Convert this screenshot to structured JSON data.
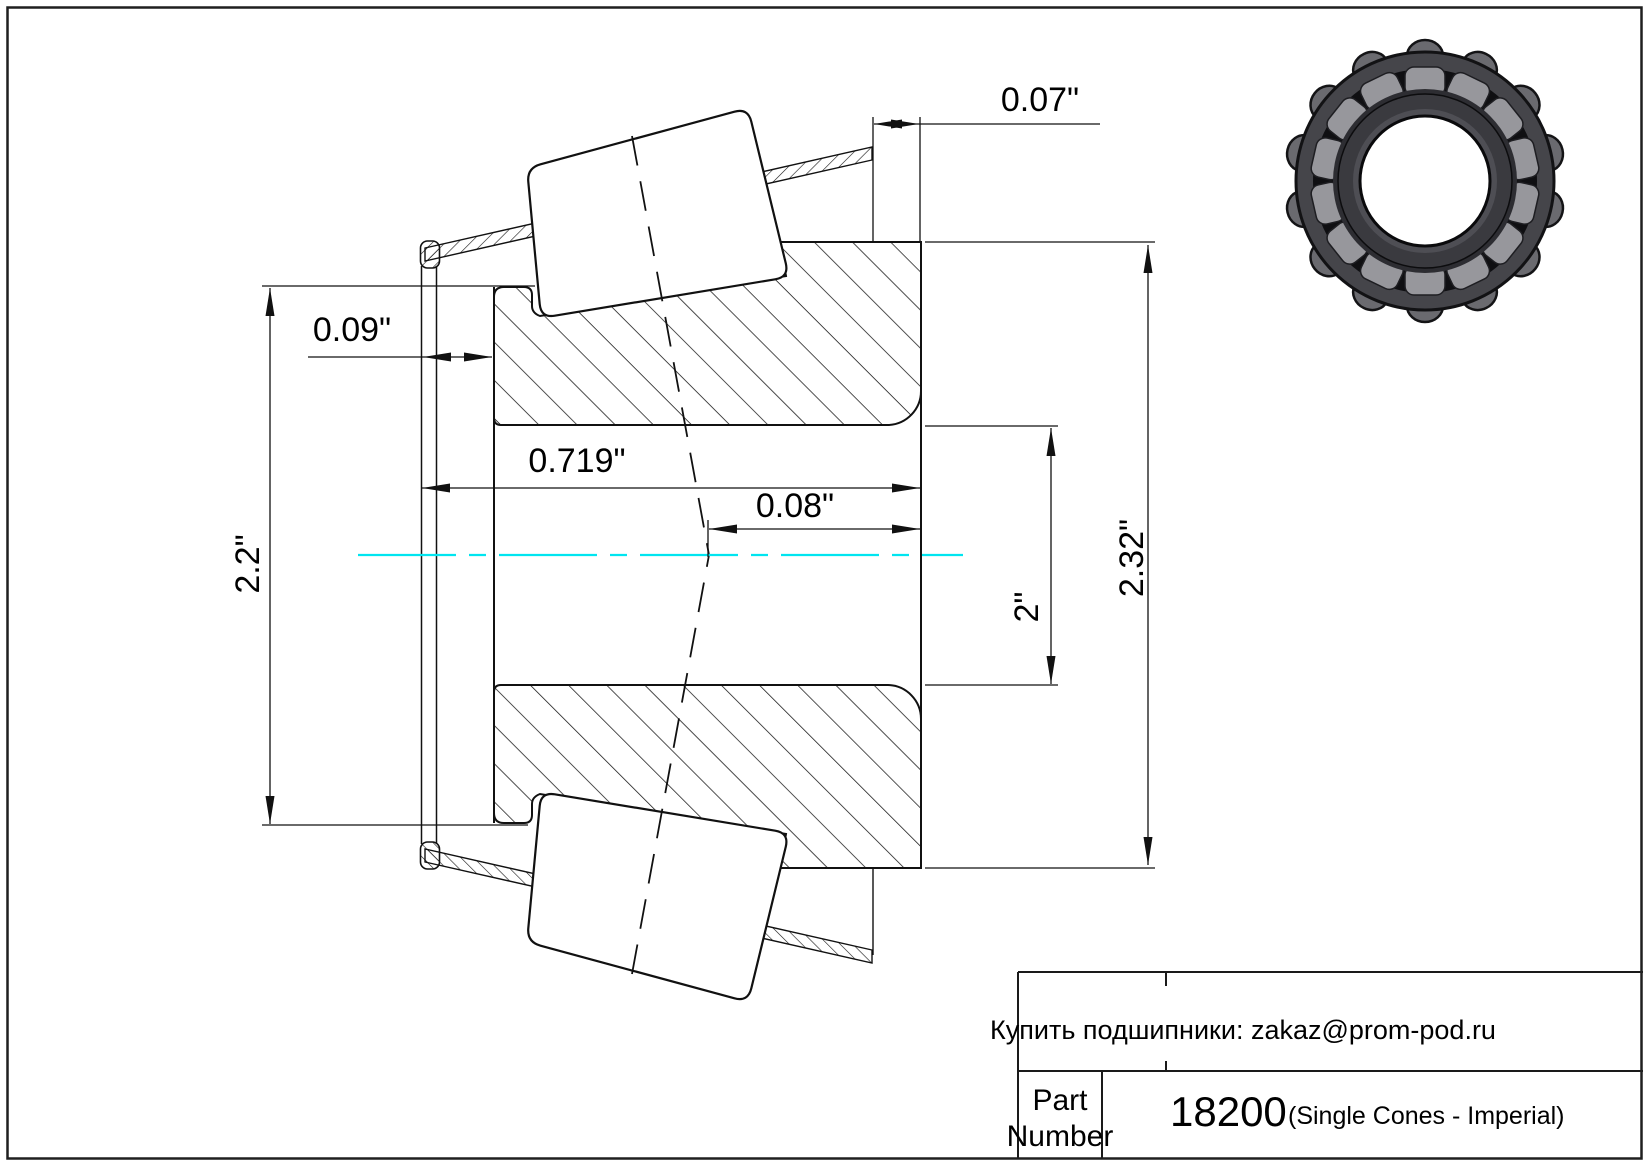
{
  "page": {
    "background": "#ffffff",
    "border_color": "#1f1f1f",
    "centerline_color": "#00e5f0",
    "line_color": "#111111"
  },
  "drawing": {
    "type": "tapered-roller-bearing-single-cone-cross-section",
    "dimensions": {
      "cage_stand_out": "0.07\"",
      "front_face_offset": "0.09\"",
      "cone_width": "0.719\"",
      "effective_center_offset": "0.08\"",
      "cage_front_diameter": "2.2\"",
      "bore_diameter": "2\"",
      "back_face_diameter": "2.32\""
    }
  },
  "title_block": {
    "note": "Купить подшипники: zakaz@prom-pod.ru",
    "part_label_line1": "Part",
    "part_label_line2": "Number",
    "part_number": "18200",
    "part_suffix": "(Single Cones - Imperial)"
  },
  "photo": {
    "name": "bearing-cone-3d-render",
    "ring_color": "#45454a",
    "roller_color": "#97979c"
  }
}
